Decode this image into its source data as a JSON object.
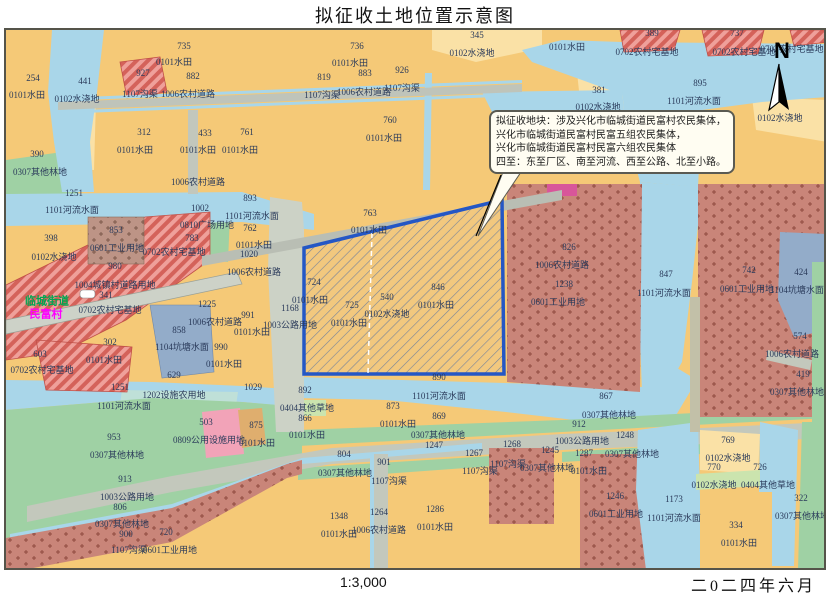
{
  "title": "拟征收土地位置示意图",
  "footer": {
    "scale": "1:3,000",
    "date": "二0二四年六月"
  },
  "north": {
    "label": "N"
  },
  "callout": {
    "lines": [
      "拟征收地块：涉及兴化市临城街道民富村农民集体，",
      "兴化市临城街道民富村民富五组农民集体，",
      "兴化市临城街道民富村民富六组农民集体",
      "四至：东至厂区、南至河流、西至公路、北至小路。"
    ]
  },
  "colors": {
    "paddy_field": "#F5C977",
    "irrigated_land": "#FAE1A6",
    "river_water": "#A9D6E9",
    "pond_water": "#93ACC9",
    "forest": "#9FD1A4",
    "grass": "#CBE4AE",
    "road": "#C3C8BC",
    "residential_hatch": "#EFA09A",
    "industrial_dots": "#C98579",
    "public_facility": "#F2A3B8",
    "block_border": "#2457C5"
  },
  "map": {
    "labels": [
      {
        "t": "735",
        "x": 178,
        "y": 16
      },
      {
        "t": "0101水田",
        "x": 168,
        "y": 32
      },
      {
        "t": "927",
        "x": 137,
        "y": 43
      },
      {
        "t": "882",
        "x": 187,
        "y": 46
      },
      {
        "t": "1107沟渠",
        "x": 134,
        "y": 64
      },
      {
        "t": "1006农村道路",
        "x": 182,
        "y": 64
      },
      {
        "t": "254",
        "x": 27,
        "y": 48
      },
      {
        "t": "0101水田",
        "x": 21,
        "y": 65
      },
      {
        "t": "441",
        "x": 79,
        "y": 51
      },
      {
        "t": "0102水浇地",
        "x": 71,
        "y": 69
      },
      {
        "t": "312",
        "x": 138,
        "y": 102
      },
      {
        "t": "0101水田",
        "x": 129,
        "y": 120
      },
      {
        "t": "433",
        "x": 199,
        "y": 103
      },
      {
        "t": "0101水田",
        "x": 192,
        "y": 120
      },
      {
        "t": "761",
        "x": 241,
        "y": 102
      },
      {
        "t": "0101水田",
        "x": 234,
        "y": 120
      },
      {
        "t": "390",
        "x": 31,
        "y": 124
      },
      {
        "t": "0307其他林地",
        "x": 34,
        "y": 142
      },
      {
        "t": "1006农村道路",
        "x": 192,
        "y": 152
      },
      {
        "t": "1251",
        "x": 68,
        "y": 163
      },
      {
        "t": "1101河流水面",
        "x": 66,
        "y": 180
      },
      {
        "t": "1002",
        "x": 194,
        "y": 178
      },
      {
        "t": "893",
        "x": 244,
        "y": 168
      },
      {
        "t": "1101河流水面",
        "x": 246,
        "y": 186
      },
      {
        "t": "0810广场用地",
        "x": 201,
        "y": 195
      },
      {
        "t": "783",
        "x": 186,
        "y": 208
      },
      {
        "t": "0702农村宅基地",
        "x": 168,
        "y": 222
      },
      {
        "t": "853",
        "x": 110,
        "y": 200
      },
      {
        "t": "0601工业用地",
        "x": 111,
        "y": 218
      },
      {
        "t": "980",
        "x": 109,
        "y": 236
      },
      {
        "t": "1004城镇村道路用地",
        "x": 109,
        "y": 255
      },
      {
        "t": "341",
        "x": 100,
        "y": 265
      },
      {
        "t": "临城街道",
        "x": 41,
        "y": 272,
        "c": "green"
      },
      {
        "t": "民富村",
        "x": 40,
        "y": 285,
        "c": "magenta"
      },
      {
        "t": "0702农村宅基地",
        "x": 104,
        "y": 280
      },
      {
        "t": "603",
        "x": 34,
        "y": 324
      },
      {
        "t": "0702农村宅基地",
        "x": 36,
        "y": 340
      },
      {
        "t": "302",
        "x": 104,
        "y": 312
      },
      {
        "t": "0101水田",
        "x": 98,
        "y": 330
      },
      {
        "t": "398",
        "x": 45,
        "y": 208
      },
      {
        "t": "0102水浇地",
        "x": 48,
        "y": 227
      },
      {
        "t": "762",
        "x": 244,
        "y": 198
      },
      {
        "t": "0101水田",
        "x": 248,
        "y": 215
      },
      {
        "t": "1020",
        "x": 243,
        "y": 224
      },
      {
        "t": "1006农村道路",
        "x": 248,
        "y": 242
      },
      {
        "t": "858",
        "x": 173,
        "y": 300
      },
      {
        "t": "1104坑塘水面",
        "x": 176,
        "y": 317
      },
      {
        "t": "629",
        "x": 168,
        "y": 345
      },
      {
        "t": "1225",
        "x": 201,
        "y": 274
      },
      {
        "t": "1006农村道路",
        "x": 209,
        "y": 292
      },
      {
        "t": "990",
        "x": 215,
        "y": 317
      },
      {
        "t": "0101水田",
        "x": 218,
        "y": 334
      },
      {
        "t": "991",
        "x": 242,
        "y": 285
      },
      {
        "t": "0101水田",
        "x": 246,
        "y": 302
      },
      {
        "t": "1168",
        "x": 284,
        "y": 278
      },
      {
        "t": "1003公路用地",
        "x": 284,
        "y": 295
      },
      {
        "t": "1029",
        "x": 247,
        "y": 357
      },
      {
        "t": "1251",
        "x": 114,
        "y": 357
      },
      {
        "t": "1101河流水面",
        "x": 118,
        "y": 376
      },
      {
        "t": "1202设施农用地",
        "x": 168,
        "y": 365
      },
      {
        "t": "736",
        "x": 351,
        "y": 16
      },
      {
        "t": "0101水田",
        "x": 344,
        "y": 33
      },
      {
        "t": "819",
        "x": 318,
        "y": 47
      },
      {
        "t": "883",
        "x": 359,
        "y": 43
      },
      {
        "t": "926",
        "x": 396,
        "y": 40
      },
      {
        "t": "1107沟渠",
        "x": 316,
        "y": 65
      },
      {
        "t": "1006农村道路",
        "x": 358,
        "y": 62
      },
      {
        "t": "1107沟渠",
        "x": 396,
        "y": 58
      },
      {
        "t": "760",
        "x": 384,
        "y": 90
      },
      {
        "t": "0101水田",
        "x": 378,
        "y": 108
      },
      {
        "t": "345",
        "x": 471,
        "y": 5
      },
      {
        "t": "0102水浇地",
        "x": 466,
        "y": 23
      },
      {
        "t": "0101水田",
        "x": 561,
        "y": 17
      },
      {
        "t": "0702农村宅基地",
        "x": 641,
        "y": 22
      },
      {
        "t": "0702农村宅基地",
        "x": 738,
        "y": 22
      },
      {
        "t": "0702农村宅基地",
        "x": 786,
        "y": 19
      },
      {
        "t": "389",
        "x": 646,
        "y": 3
      },
      {
        "t": "737",
        "x": 731,
        "y": 3
      },
      {
        "t": "895",
        "x": 694,
        "y": 53
      },
      {
        "t": "1101河流水面",
        "x": 688,
        "y": 71
      },
      {
        "t": "381",
        "x": 593,
        "y": 60
      },
      {
        "t": "0102水浇地",
        "x": 592,
        "y": 77
      },
      {
        "t": "0102水浇地",
        "x": 774,
        "y": 88
      },
      {
        "t": "763",
        "x": 364,
        "y": 183
      },
      {
        "t": "0101水田",
        "x": 363,
        "y": 200
      },
      {
        "t": "724",
        "x": 308,
        "y": 252
      },
      {
        "t": "0101水田",
        "x": 304,
        "y": 270
      },
      {
        "t": "725",
        "x": 346,
        "y": 275
      },
      {
        "t": "0101水田",
        "x": 343,
        "y": 293
      },
      {
        "t": "540",
        "x": 381,
        "y": 267
      },
      {
        "t": "0102水浇地",
        "x": 381,
        "y": 284
      },
      {
        "t": "846",
        "x": 432,
        "y": 257
      },
      {
        "t": "0101水田",
        "x": 430,
        "y": 275
      },
      {
        "t": "890",
        "x": 433,
        "y": 347
      },
      {
        "t": "826",
        "x": 563,
        "y": 217
      },
      {
        "t": "1006农村道路",
        "x": 556,
        "y": 235
      },
      {
        "t": "1238",
        "x": 558,
        "y": 254
      },
      {
        "t": "0601工业用地",
        "x": 552,
        "y": 272
      },
      {
        "t": "847",
        "x": 660,
        "y": 244
      },
      {
        "t": "1101河流水面",
        "x": 658,
        "y": 263
      },
      {
        "t": "742",
        "x": 743,
        "y": 240
      },
      {
        "t": "0601工业用地",
        "x": 741,
        "y": 259
      },
      {
        "t": "424",
        "x": 795,
        "y": 242
      },
      {
        "t": "1104坑塘水面",
        "x": 791,
        "y": 260
      },
      {
        "t": "574",
        "x": 794,
        "y": 306
      },
      {
        "t": "1006农村道路",
        "x": 786,
        "y": 324
      },
      {
        "t": "419",
        "x": 797,
        "y": 344
      },
      {
        "t": "0307其他林地",
        "x": 791,
        "y": 362
      },
      {
        "t": "892",
        "x": 299,
        "y": 360
      },
      {
        "t": "0404其他草地",
        "x": 301,
        "y": 378
      },
      {
        "t": "866",
        "x": 299,
        "y": 388
      },
      {
        "t": "0101水田",
        "x": 301,
        "y": 405
      },
      {
        "t": "1101河流水面",
        "x": 433,
        "y": 366
      },
      {
        "t": "873",
        "x": 387,
        "y": 376
      },
      {
        "t": "0101水田",
        "x": 392,
        "y": 394
      },
      {
        "t": "869",
        "x": 433,
        "y": 386
      },
      {
        "t": "0307其他林地",
        "x": 432,
        "y": 405
      },
      {
        "t": "1247",
        "x": 428,
        "y": 415
      },
      {
        "t": "804",
        "x": 338,
        "y": 424
      },
      {
        "t": "1267",
        "x": 468,
        "y": 423
      },
      {
        "t": "1268",
        "x": 506,
        "y": 414
      },
      {
        "t": "901",
        "x": 378,
        "y": 432
      },
      {
        "t": "0307其他林地",
        "x": 339,
        "y": 443
      },
      {
        "t": "1107沟渠",
        "x": 383,
        "y": 451
      },
      {
        "t": "1107沟渠",
        "x": 474,
        "y": 441
      },
      {
        "t": "1107沟渠",
        "x": 502,
        "y": 434
      },
      {
        "t": "0307其他林地",
        "x": 541,
        "y": 438
      },
      {
        "t": "1348",
        "x": 333,
        "y": 486
      },
      {
        "t": "0101水田",
        "x": 333,
        "y": 504
      },
      {
        "t": "1264",
        "x": 373,
        "y": 482
      },
      {
        "t": "1006农村道路",
        "x": 373,
        "y": 500
      },
      {
        "t": "1286",
        "x": 429,
        "y": 479
      },
      {
        "t": "0101水田",
        "x": 429,
        "y": 497
      },
      {
        "t": "953",
        "x": 108,
        "y": 407
      },
      {
        "t": "0307其他林地",
        "x": 111,
        "y": 425
      },
      {
        "t": "913",
        "x": 119,
        "y": 449
      },
      {
        "t": "1003公路用地",
        "x": 121,
        "y": 467
      },
      {
        "t": "806",
        "x": 114,
        "y": 477
      },
      {
        "t": "0307其他林地",
        "x": 116,
        "y": 494
      },
      {
        "t": "900",
        "x": 120,
        "y": 504
      },
      {
        "t": "720",
        "x": 160,
        "y": 502
      },
      {
        "t": "1107沟渠",
        "x": 123,
        "y": 520
      },
      {
        "t": "0601工业用地",
        "x": 164,
        "y": 520
      },
      {
        "t": "503",
        "x": 200,
        "y": 392
      },
      {
        "t": "0809公用设施用地",
        "x": 203,
        "y": 410
      },
      {
        "t": "875",
        "x": 250,
        "y": 395
      },
      {
        "t": "0101水田",
        "x": 251,
        "y": 413
      },
      {
        "t": "867",
        "x": 600,
        "y": 366
      },
      {
        "t": "0307其他林地",
        "x": 603,
        "y": 385
      },
      {
        "t": "912",
        "x": 573,
        "y": 394
      },
      {
        "t": "1003公路用地",
        "x": 576,
        "y": 411
      },
      {
        "t": "1248",
        "x": 619,
        "y": 405
      },
      {
        "t": "0307其他林地",
        "x": 626,
        "y": 424
      },
      {
        "t": "1245",
        "x": 544,
        "y": 420
      },
      {
        "t": "1287",
        "x": 578,
        "y": 423
      },
      {
        "t": "0101水田",
        "x": 583,
        "y": 441
      },
      {
        "t": "1246",
        "x": 609,
        "y": 466
      },
      {
        "t": "0601工业用地",
        "x": 610,
        "y": 484
      },
      {
        "t": "1173",
        "x": 668,
        "y": 469
      },
      {
        "t": "1101河流水面",
        "x": 668,
        "y": 488
      },
      {
        "t": "769",
        "x": 722,
        "y": 410
      },
      {
        "t": "0102水浇地",
        "x": 722,
        "y": 428
      },
      {
        "t": "770",
        "x": 708,
        "y": 437
      },
      {
        "t": "726",
        "x": 754,
        "y": 437
      },
      {
        "t": "0102水浇地",
        "x": 708,
        "y": 455
      },
      {
        "t": "0404其他草地",
        "x": 762,
        "y": 455
      },
      {
        "t": "334",
        "x": 730,
        "y": 495
      },
      {
        "t": "0101水田",
        "x": 733,
        "y": 513
      },
      {
        "t": "322",
        "x": 795,
        "y": 468
      },
      {
        "t": "0307其他林地",
        "x": 796,
        "y": 486
      }
    ]
  }
}
